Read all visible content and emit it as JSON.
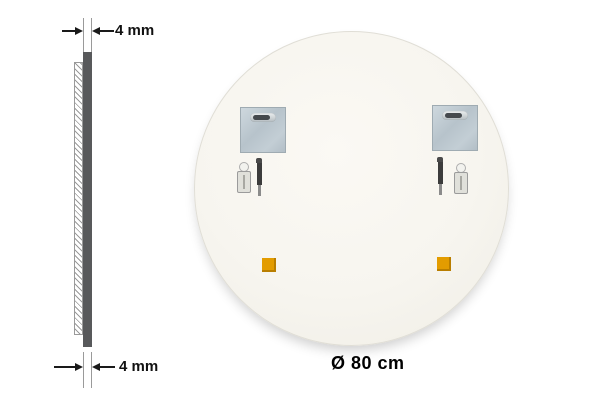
{
  "side_view": {
    "top_thickness_label": "4 mm",
    "bottom_thickness_label": "4 mm"
  },
  "mirror": {
    "diameter_label": "Ø 80 cm"
  },
  "icons": {
    "mounting_plate": "keyhole-mounting-plate-icon",
    "keyhole_slot": "keyhole-slot-icon",
    "screw": "screw-icon",
    "wall_anchor": "wall-anchor-icon",
    "adhesive_pad": "adhesive-pad-icon",
    "dimension_arrow": "dimension-arrow-icon"
  },
  "colors": {
    "background": "#ffffff",
    "mirror_back": "#f7f5ef",
    "mirror_edge": "#e0ded6",
    "side_profile_bar": "#58595b",
    "hatch_line": "#9a9a9a",
    "dimension_line": "#1a1a1a",
    "plate": "#bfcad2",
    "plate_border": "#9fabb2",
    "slot_dark": "#45494d",
    "screw_dark": "#3c3c3c",
    "anchor_light": "#e0e0da",
    "adhesive_pad_orange": "#e39c00",
    "adhesive_pad_shadow": "#b97e00"
  }
}
